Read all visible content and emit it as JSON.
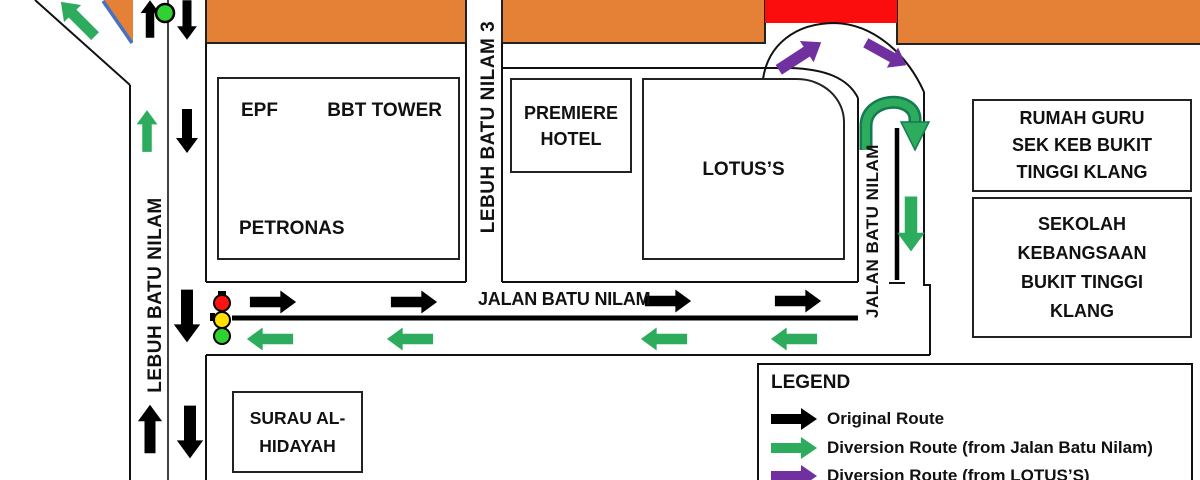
{
  "colors": {
    "road_closed_orange": "#E58137",
    "closure_red": "#FC0D0D",
    "original_route_black": "#000000",
    "diversion_green": "#2EAC5E",
    "diversion_purple": "#7030A0",
    "ramp_blue": "#4472C4",
    "traffic_light_red": "#FF1212",
    "traffic_light_yellow": "#FFE000",
    "traffic_light_green": "#2FD32F"
  },
  "buildings": {
    "epf": "EPF",
    "bbt_tower": "BBT TOWER",
    "petronas": "PETRONAS",
    "premiere_hotel": {
      "line1": "PREMIERE",
      "line2": "HOTEL"
    },
    "lotus": "LOTUS’S",
    "rumah_guru": {
      "line1": "RUMAH GURU",
      "line2": "SEK KEB BUKIT",
      "line3": "TINGGI KLANG"
    },
    "sekolah": {
      "line1": "SEKOLAH",
      "line2": "KEBANGSAAN",
      "line3": "BUKIT TINGGI",
      "line4": "KLANG"
    },
    "surau": {
      "line1": "SURAU AL-",
      "line2": "HIDAYAH"
    }
  },
  "roads": {
    "left_vertical": "LEBUH BATU NILAM",
    "middle_vertical": "LEBUH BATU NILAM 3",
    "right_vertical": "JALAN BATU NILAM",
    "horizontal": "JALAN BATU NILAM"
  },
  "legend": {
    "title": "LEGEND",
    "items": [
      {
        "label": "Original Route",
        "color": "#000000"
      },
      {
        "label": "Diversion Route (from Jalan Batu Nilam)",
        "color": "#2EAC5E"
      },
      {
        "label": "Diversion Route (from LOTUS’S)",
        "color": "#7030A0"
      }
    ]
  }
}
